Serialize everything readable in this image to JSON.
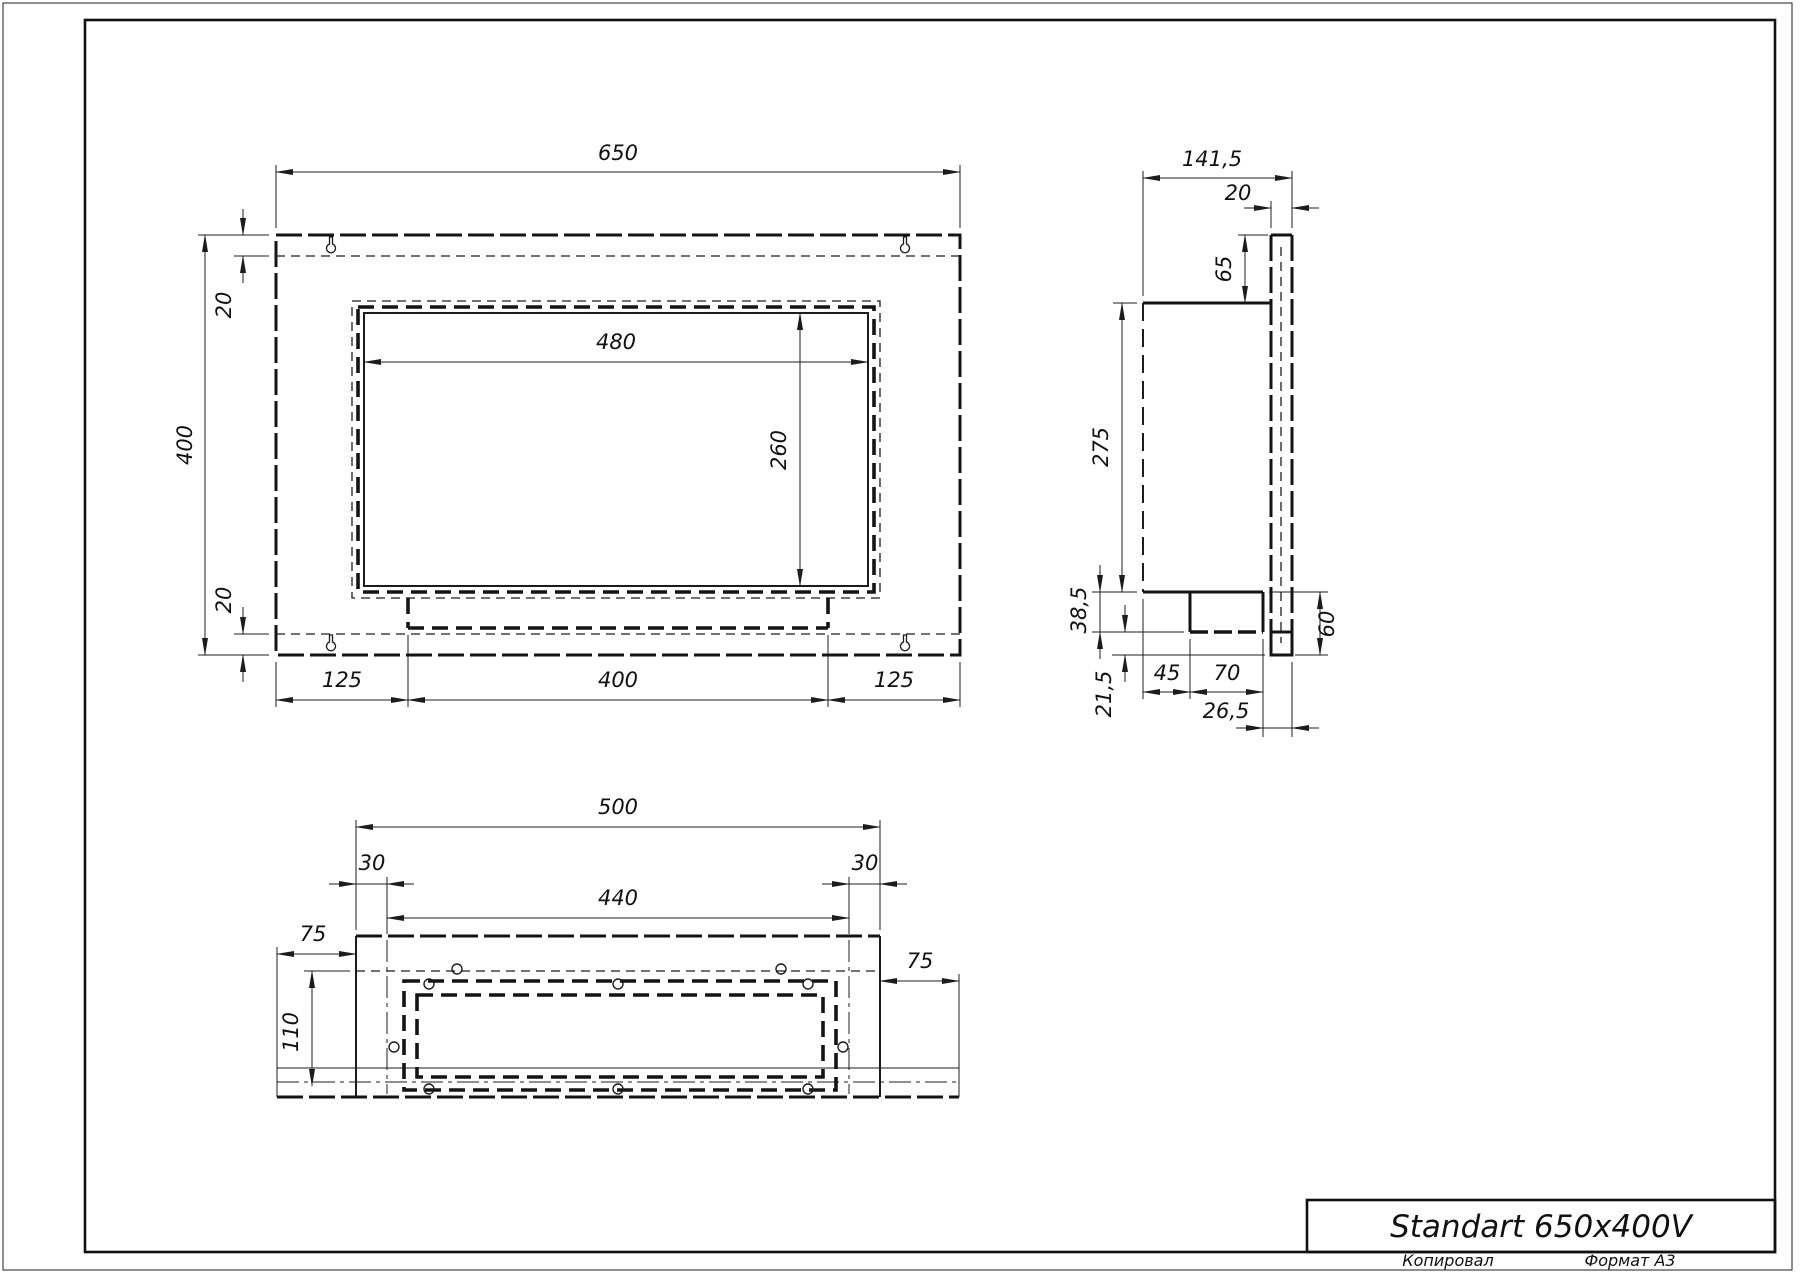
{
  "drawing": {
    "title_block": {
      "title": "Standart 650x400V"
    },
    "footer": {
      "copied_label": "Копировал",
      "format_label": "Формат А3"
    },
    "views": {
      "front": {
        "total_width": "650",
        "total_height": "400",
        "top_fold": "20",
        "bottom_fold": "20",
        "opening_width": "480",
        "opening_height": "260",
        "left_offset": "125",
        "center_width": "400",
        "right_offset": "125"
      },
      "side": {
        "total_depth": "141,5",
        "flange_thickness": "20",
        "flange_top": "65",
        "body_depth": "275",
        "tray_height": "38,5",
        "bottom_gap": "21,5",
        "tray_offset": "45",
        "tray_width": "70",
        "tray_to_front": "26,5",
        "front_lip": "60"
      },
      "bottom": {
        "box_width": "500",
        "side_inset_left": "30",
        "inner_width": "440",
        "side_inset_right": "30",
        "flange_left": "75",
        "inner_depth": "110",
        "flange_right": "75"
      }
    }
  }
}
